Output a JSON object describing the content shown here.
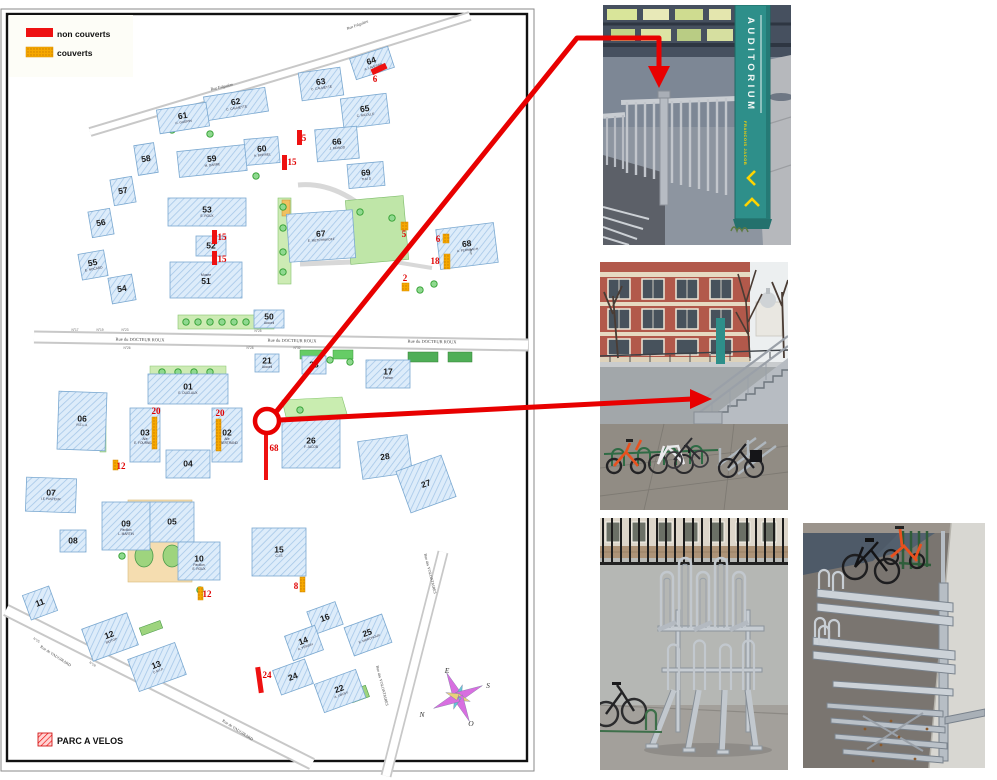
{
  "legend": {
    "items": [
      {
        "label": "non couverts",
        "type": "red",
        "color": "#ee1111"
      },
      {
        "label": "couverts",
        "type": "orange",
        "color": "#f6a800"
      }
    ]
  },
  "map": {
    "parc_a_velos_label": "PARC A VELOS",
    "compass": {
      "letters": [
        {
          "ch": "E",
          "x": 447,
          "y": 673
        },
        {
          "ch": "S",
          "x": 488,
          "y": 688
        },
        {
          "ch": "O",
          "x": 471,
          "y": 726
        },
        {
          "ch": "N",
          "x": 422,
          "y": 717
        }
      ]
    },
    "streets": [
      {
        "name": "Rue Falguière",
        "x": 222,
        "y": 88,
        "rot": -13,
        "size": 4
      },
      {
        "name": "Rue Falguière",
        "x": 358,
        "y": 26,
        "rot": -20,
        "size": 4
      },
      {
        "name": "Rue du DOCTEUR ROUX",
        "x": 140,
        "y": 341,
        "rot": 1,
        "size": 4.5
      },
      {
        "name": "Rue du DOCTEUR ROUX",
        "x": 292,
        "y": 342,
        "rot": 1,
        "size": 4.5
      },
      {
        "name": "Rue du DOCTEUR ROUX",
        "x": 432,
        "y": 343,
        "rot": 1,
        "size": 4.5
      },
      {
        "name": "Rue de VAUGIRARD",
        "x": 55,
        "y": 657,
        "rot": 33,
        "size": 4
      },
      {
        "name": "Rue de VAUGIRARD",
        "x": 237,
        "y": 731,
        "rot": 33,
        "size": 4
      },
      {
        "name": "Rue des VOLONTAIRES",
        "x": 429,
        "y": 574,
        "rot": 76,
        "size": 4
      },
      {
        "name": "Rue des VOLONTAIRES",
        "x": 381,
        "y": 686,
        "rot": 76,
        "size": 4
      },
      {
        "name": "Rue",
        "x": 470,
        "y": 252,
        "rot": 78,
        "size": 3.5
      }
    ],
    "street_numbers": [
      {
        "label": "N°17",
        "x": 75,
        "y": 331,
        "rot": 0
      },
      {
        "label": "N°19",
        "x": 100,
        "y": 331,
        "rot": 0
      },
      {
        "label": "N°23",
        "x": 125,
        "y": 331,
        "rot": 0
      },
      {
        "label": "N°25",
        "x": 258,
        "y": 332,
        "rot": 0
      },
      {
        "label": "N°26",
        "x": 127,
        "y": 349,
        "rot": 0
      },
      {
        "label": "N°28",
        "x": 250,
        "y": 349,
        "rot": 0
      },
      {
        "label": "N°32",
        "x": 297,
        "y": 349,
        "rot": 0
      },
      {
        "label": "N°25",
        "x": 36,
        "y": 641,
        "rot": 33
      },
      {
        "label": "N°28",
        "x": 92,
        "y": 665,
        "rot": 33
      }
    ],
    "buildings": [
      {
        "num": "64",
        "sub": "A. LAVERAN",
        "x": 352,
        "y": 52,
        "w": 40,
        "h": 22,
        "rot": -18
      },
      {
        "num": "63",
        "sub": "C. CALMETTE",
        "x": 300,
        "y": 70,
        "w": 42,
        "h": 28,
        "rot": -8
      },
      {
        "num": "62",
        "sub": "C. CALMETTE",
        "x": 205,
        "y": 92,
        "w": 62,
        "h": 24,
        "rot": -9
      },
      {
        "num": "61",
        "sub": "C. GUERIN",
        "x": 158,
        "y": 106,
        "w": 50,
        "h": 24,
        "rot": -9
      },
      {
        "num": "65",
        "sub": "C. NICOLLE",
        "x": 342,
        "y": 96,
        "w": 46,
        "h": 30,
        "rot": -7
      },
      {
        "num": "66",
        "sub": "J. MONOD",
        "x": 316,
        "y": 128,
        "w": 42,
        "h": 32,
        "rot": -5
      },
      {
        "num": "69",
        "sub": "THU D",
        "x": 348,
        "y": 163,
        "w": 36,
        "h": 24,
        "rot": -5
      },
      {
        "num": "60",
        "sub": "A. BORREL",
        "x": 245,
        "y": 138,
        "w": 34,
        "h": 26,
        "rot": -5
      },
      {
        "num": "59",
        "sub": "M. DARRE",
        "x": 178,
        "y": 148,
        "w": 68,
        "h": 26,
        "rot": -6
      },
      {
        "num": "58",
        "x": 136,
        "y": 144,
        "w": 20,
        "h": 30,
        "rot": -9
      },
      {
        "num": "57",
        "x": 112,
        "y": 178,
        "w": 22,
        "h": 26,
        "rot": -10
      },
      {
        "num": "56",
        "x": 90,
        "y": 210,
        "w": 22,
        "h": 26,
        "rot": -10
      },
      {
        "num": "55",
        "sub": "E. NOCARD",
        "x": 80,
        "y": 252,
        "w": 26,
        "h": 26,
        "rot": -10
      },
      {
        "num": "54",
        "x": 110,
        "y": 276,
        "w": 24,
        "h": 26,
        "rot": -10
      },
      {
        "num": "53",
        "sub": "E. ROUX",
        "x": 168,
        "y": 198,
        "w": 78,
        "h": 28,
        "rot": 0
      },
      {
        "num": "52",
        "x": 196,
        "y": 236,
        "w": 30,
        "h": 20,
        "rot": 0
      },
      {
        "num": "51",
        "sub": "Musée",
        "subAbove": true,
        "x": 170,
        "y": 262,
        "w": 72,
        "h": 36,
        "rot": 0
      },
      {
        "num": "50",
        "sub": "Accueil",
        "x": 254,
        "y": 310,
        "w": 30,
        "h": 18,
        "rot": 0
      },
      {
        "num": "67",
        "sub": "E. METCHNIKOFF",
        "x": 288,
        "y": 212,
        "w": 66,
        "h": 48,
        "rot": -4
      },
      {
        "num": "68",
        "sub": "A. FERNBACH",
        "x": 438,
        "y": 226,
        "w": 58,
        "h": 40,
        "rot": -7
      },
      {
        "num": "21",
        "sub": "Accueil",
        "x": 255,
        "y": 354,
        "w": 24,
        "h": 18,
        "rot": 0
      },
      {
        "num": "23",
        "x": 302,
        "y": 356,
        "w": 24,
        "h": 18,
        "rot": 0
      },
      {
        "num": "17",
        "sub": "France",
        "x": 366,
        "y": 360,
        "w": 44,
        "h": 28,
        "rot": 0
      },
      {
        "num": "01",
        "sub": "E. DUCLAUX",
        "x": 148,
        "y": 374,
        "w": 80,
        "h": 30,
        "rot": 0
      },
      {
        "num": "03",
        "sub": "Aile|E. FOURNEAU",
        "x": 130,
        "y": 408,
        "w": 30,
        "h": 54,
        "rot": 0
      },
      {
        "num": "02",
        "sub": "Aile|G. BERTRAND",
        "x": 212,
        "y": 408,
        "w": 30,
        "h": 54,
        "rot": 0
      },
      {
        "num": "04",
        "x": 166,
        "y": 450,
        "w": 44,
        "h": 28,
        "rot": 0
      },
      {
        "num": "06",
        "sub": "R.E.L.A",
        "x": 58,
        "y": 392,
        "w": 48,
        "h": 58,
        "rot": 2
      },
      {
        "num": "07",
        "sub": "LE PASTEUR",
        "x": 26,
        "y": 478,
        "w": 50,
        "h": 34,
        "rot": 2
      },
      {
        "num": "08",
        "x": 60,
        "y": 530,
        "w": 26,
        "h": 22,
        "rot": 0
      },
      {
        "num": "09",
        "sub": "Pavillon|L. MARTIN",
        "x": 102,
        "y": 502,
        "w": 48,
        "h": 48,
        "rot": 0
      },
      {
        "num": "05",
        "x": 150,
        "y": 502,
        "w": 44,
        "h": 40,
        "rot": 0
      },
      {
        "num": "10",
        "sub": "Pavillon|E. ROUX",
        "x": 178,
        "y": 542,
        "w": 42,
        "h": 38,
        "rot": 0
      },
      {
        "num": "15",
        "sub": "C.I.S",
        "x": 252,
        "y": 528,
        "w": 54,
        "h": 48,
        "rot": 0
      },
      {
        "num": "11",
        "x": 26,
        "y": 590,
        "w": 28,
        "h": 26,
        "rot": -20
      },
      {
        "num": "12",
        "sub": "BIOTOP",
        "x": 86,
        "y": 620,
        "w": 48,
        "h": 34,
        "rot": -20
      },
      {
        "num": "13",
        "sub": "C.M.I.P.",
        "x": 132,
        "y": 650,
        "w": 50,
        "h": 34,
        "rot": -20
      },
      {
        "num": "16",
        "x": 310,
        "y": 606,
        "w": 30,
        "h": 24,
        "rot": -20
      },
      {
        "num": "25",
        "sub": "E. MARCHOUX",
        "x": 348,
        "y": 620,
        "w": 40,
        "h": 30,
        "rot": -20
      },
      {
        "num": "14",
        "sub": "A. YERSIN",
        "x": 288,
        "y": 630,
        "w": 32,
        "h": 26,
        "rot": -20
      },
      {
        "num": "24",
        "x": 276,
        "y": 664,
        "w": 34,
        "h": 26,
        "rot": -20
      },
      {
        "num": "22",
        "sub": "A. LWOFF",
        "x": 318,
        "y": 676,
        "w": 44,
        "h": 30,
        "rot": -20
      },
      {
        "num": "26",
        "sub": "F. JACOB",
        "x": 282,
        "y": 418,
        "w": 58,
        "h": 50,
        "rot": 0
      },
      {
        "num": "28",
        "x": 360,
        "y": 438,
        "w": 50,
        "h": 38,
        "rot": -8
      },
      {
        "num": "27",
        "x": 402,
        "y": 462,
        "w": 48,
        "h": 44,
        "rot": -20
      }
    ],
    "markers": [
      {
        "num": "6",
        "type": "red",
        "x": 371,
        "y": 66,
        "w": 16,
        "h": 6,
        "rot": -25,
        "lx": 375,
        "ly": 82
      },
      {
        "num": "5",
        "type": "red",
        "x": 297,
        "y": 130,
        "w": 5,
        "h": 15,
        "rot": 0,
        "lx": 304,
        "ly": 141
      },
      {
        "num": "15",
        "type": "red",
        "x": 282,
        "y": 155,
        "w": 5,
        "h": 15,
        "rot": 0,
        "lx": 292,
        "ly": 165
      },
      {
        "num": "15",
        "type": "red",
        "x": 212,
        "y": 230,
        "w": 5,
        "h": 14,
        "rot": 0,
        "lx": 222,
        "ly": 240
      },
      {
        "num": "15",
        "type": "red",
        "x": 212,
        "y": 251,
        "w": 5,
        "h": 14,
        "rot": 0,
        "lx": 222,
        "ly": 262
      },
      {
        "num": "68",
        "type": "red",
        "x": 264,
        "y": 433,
        "w": 4,
        "h": 47,
        "rot": 0,
        "lx": 274,
        "ly": 451
      },
      {
        "num": "24",
        "type": "red",
        "x": 257,
        "y": 667,
        "w": 5,
        "h": 26,
        "rot": -8,
        "lx": 267,
        "ly": 678
      },
      {
        "num": "5",
        "type": "orange",
        "x": 401,
        "y": 222,
        "w": 7,
        "h": 8,
        "rot": 0,
        "lx": 404,
        "ly": 237
      },
      {
        "num": "6",
        "type": "orange",
        "x": 443,
        "y": 234,
        "w": 6,
        "h": 9,
        "rot": 0,
        "lx": 438,
        "ly": 242
      },
      {
        "num": "18",
        "type": "orange",
        "x": 444,
        "y": 254,
        "w": 6,
        "h": 15,
        "rot": 0,
        "lx": 435,
        "ly": 264
      },
      {
        "num": "2",
        "type": "orange",
        "x": 402,
        "y": 283,
        "w": 7,
        "h": 8,
        "rot": 0,
        "lx": 405,
        "ly": 281
      },
      {
        "num": "20",
        "type": "orange",
        "x": 152,
        "y": 417,
        "w": 5,
        "h": 32,
        "rot": 0,
        "lx": 156,
        "ly": 414
      },
      {
        "num": "20",
        "type": "orange",
        "x": 216,
        "y": 419,
        "w": 5,
        "h": 32,
        "rot": 0,
        "lx": 220,
        "ly": 416
      },
      {
        "num": "12",
        "type": "orange",
        "x": 113,
        "y": 460,
        "w": 5,
        "h": 10,
        "rot": 0,
        "lx": 121,
        "ly": 469
      },
      {
        "num": "12",
        "type": "orange",
        "x": 198,
        "y": 587,
        "w": 5,
        "h": 13,
        "rot": 0,
        "lx": 207,
        "ly": 597
      },
      {
        "num": "8",
        "type": "orange",
        "x": 300,
        "y": 577,
        "w": 5,
        "h": 15,
        "rot": 0,
        "lx": 296,
        "ly": 589
      }
    ]
  },
  "photos": {
    "top": {
      "sign_title": "AUDITORIUM",
      "sign_subtitle": "FRANCOIS JACOB"
    },
    "middle": {
      "description": "sunken bike parking with staircase"
    },
    "bottom_left": {
      "description": "two-tier bike rack front view"
    },
    "bottom_right": {
      "description": "two-tier bike rack side view"
    }
  },
  "colors": {
    "non_couverts": "#ee1111",
    "couverts": "#f6a800",
    "arrow": "#e80000",
    "building_fill": "#dcebfa",
    "sign_teal": "#2e8f8a"
  }
}
